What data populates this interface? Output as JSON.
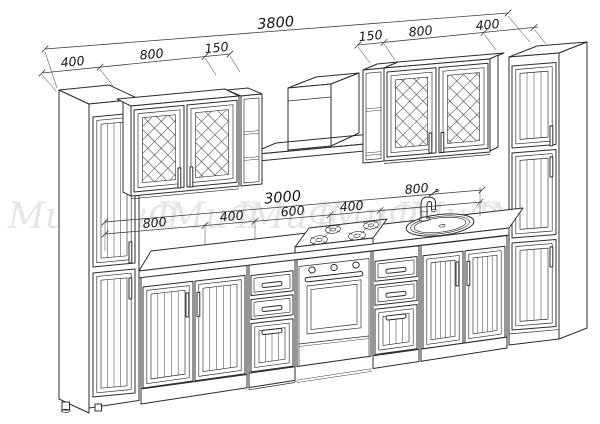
{
  "drawing": {
    "background": "#ffffff",
    "line_color": "#2d2d2d",
    "dimension_text_color": "#161616",
    "watermark": {
      "text": "МиФ",
      "color": "#e8e5e5",
      "repeat": 7
    },
    "dimensions_mm": {
      "top_total": "3800",
      "top_left_segments": [
        "400",
        "800",
        "150"
      ],
      "top_right_segments": [
        "150",
        "800",
        "400"
      ],
      "middle_total": "3000",
      "middle_segments": [
        "800",
        "400",
        "600",
        "400",
        "800"
      ]
    }
  }
}
